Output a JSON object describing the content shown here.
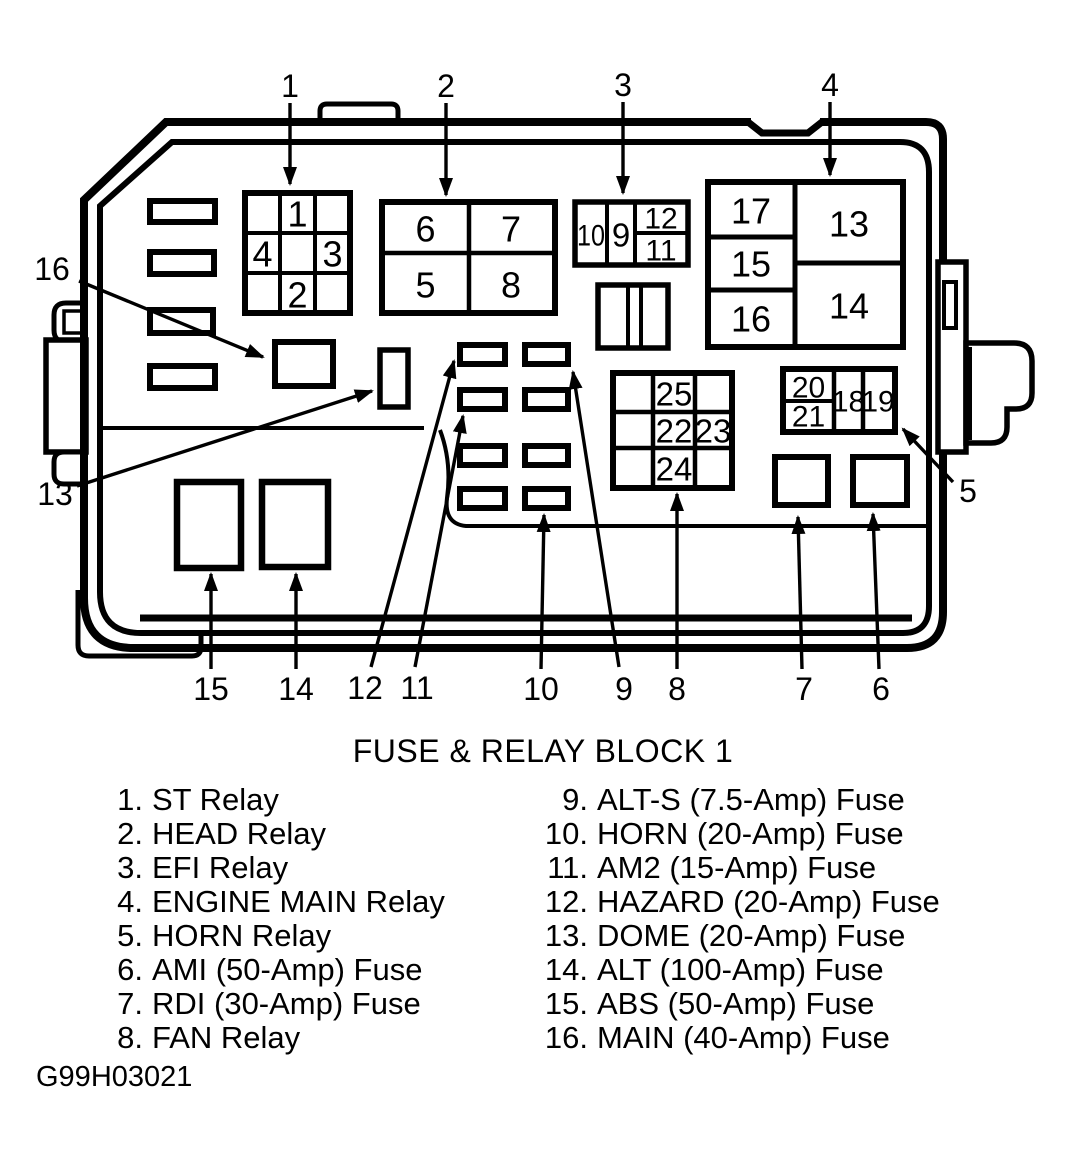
{
  "title": "FUSE & RELAY BLOCK 1",
  "figure_code": "G99H03021",
  "box": {
    "relay_grid": {
      "top": "1",
      "left": "4",
      "right": "3",
      "bottom": "2"
    },
    "quad_block": {
      "tl": "6",
      "tr": "7",
      "bl": "5",
      "br": "8"
    },
    "fuse_strip": {
      "c1": "10",
      "c2": "9",
      "c3_top": "12",
      "c3_bot": "11"
    },
    "main_block": {
      "l1": "17",
      "l2": "15",
      "l3": "16",
      "r1": "13",
      "r2": "14"
    },
    "center_block": {
      "r1": "25",
      "r2a": "22",
      "r2b": "23",
      "r3": "24"
    },
    "right_strip": {
      "c1_top": "20",
      "c1_bot": "21",
      "c2": "18",
      "c3": "19"
    }
  },
  "callouts": {
    "c1": "1",
    "c2": "2",
    "c3": "3",
    "c4": "4",
    "c5": "5",
    "c6": "6",
    "c7": "7",
    "c8": "8",
    "c9": "9",
    "c10": "10",
    "c11": "11",
    "c12": "12",
    "c13": "13",
    "c14": "14",
    "c15": "15",
    "c16": "16"
  },
  "legend": {
    "left": [
      {
        "num": "1.",
        "label": "ST Relay"
      },
      {
        "num": "2.",
        "label": "HEAD Relay"
      },
      {
        "num": "3.",
        "label": "EFI Relay"
      },
      {
        "num": "4.",
        "label": "ENGINE MAIN Relay"
      },
      {
        "num": "5.",
        "label": "HORN Relay"
      },
      {
        "num": "6.",
        "label": "AMI (50-Amp) Fuse"
      },
      {
        "num": "7.",
        "label": "RDI (30-Amp) Fuse"
      },
      {
        "num": "8.",
        "label": "FAN Relay"
      }
    ],
    "right": [
      {
        "num": "9.",
        "label": "ALT-S (7.5-Amp) Fuse"
      },
      {
        "num": "10.",
        "label": "HORN (20-Amp) Fuse"
      },
      {
        "num": "11.",
        "label": "AM2 (15-Amp) Fuse"
      },
      {
        "num": "12.",
        "label": "HAZARD (20-Amp) Fuse"
      },
      {
        "num": "13.",
        "label": "DOME (20-Amp) Fuse"
      },
      {
        "num": "14.",
        "label": "ALT (100-Amp) Fuse"
      },
      {
        "num": "15.",
        "label": "ABS (50-Amp) Fuse"
      },
      {
        "num": "16.",
        "label": "MAIN (40-Amp) Fuse"
      }
    ]
  }
}
